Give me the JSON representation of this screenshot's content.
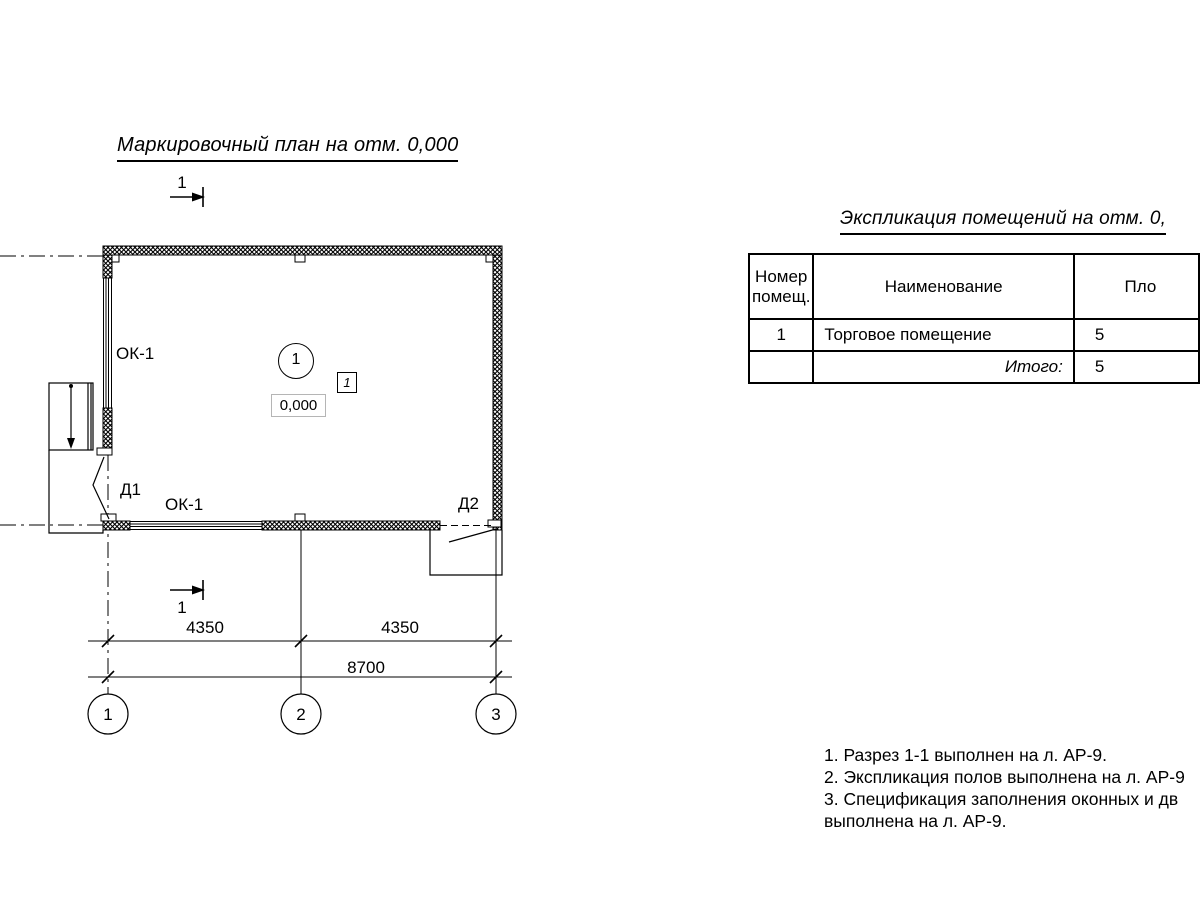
{
  "colors": {
    "line": "#000000",
    "background": "#ffffff",
    "elevation_box_border": "#b5b5b5"
  },
  "plan": {
    "title": "Маркировочный план на отм. 0,000",
    "section_label_top": "1",
    "section_label_bottom": "1",
    "window_left_label": "ОК-1",
    "window_bottom_label": "ОК-1",
    "door1_label": "Д1",
    "door2_label": "Д2",
    "room_number": "1",
    "floor_type_mark": "1",
    "elevation_mark": "0,000",
    "dim_left": "4350",
    "dim_right": "4350",
    "dim_total": "8700",
    "axis_1": "1",
    "axis_2": "2",
    "axis_3": "3"
  },
  "explication": {
    "title": "Экспликация помещений на отм. 0,",
    "col_number": "Номер помещ.",
    "col_name": "Наименование",
    "col_area": "Пло",
    "row1_number": "1",
    "row1_name": "Торговое помещение",
    "row1_area": "5",
    "total_label": "Итого:",
    "total_area": "5"
  },
  "notes": {
    "line1": "1. Разрез 1-1 выполнен на л. АР-9.",
    "line2": "2. Экспликация полов выполнена на л. АР-9",
    "line3": "3. Спецификация заполнения оконных и дв",
    "line4": "выполнена  на л. АР-9."
  }
}
